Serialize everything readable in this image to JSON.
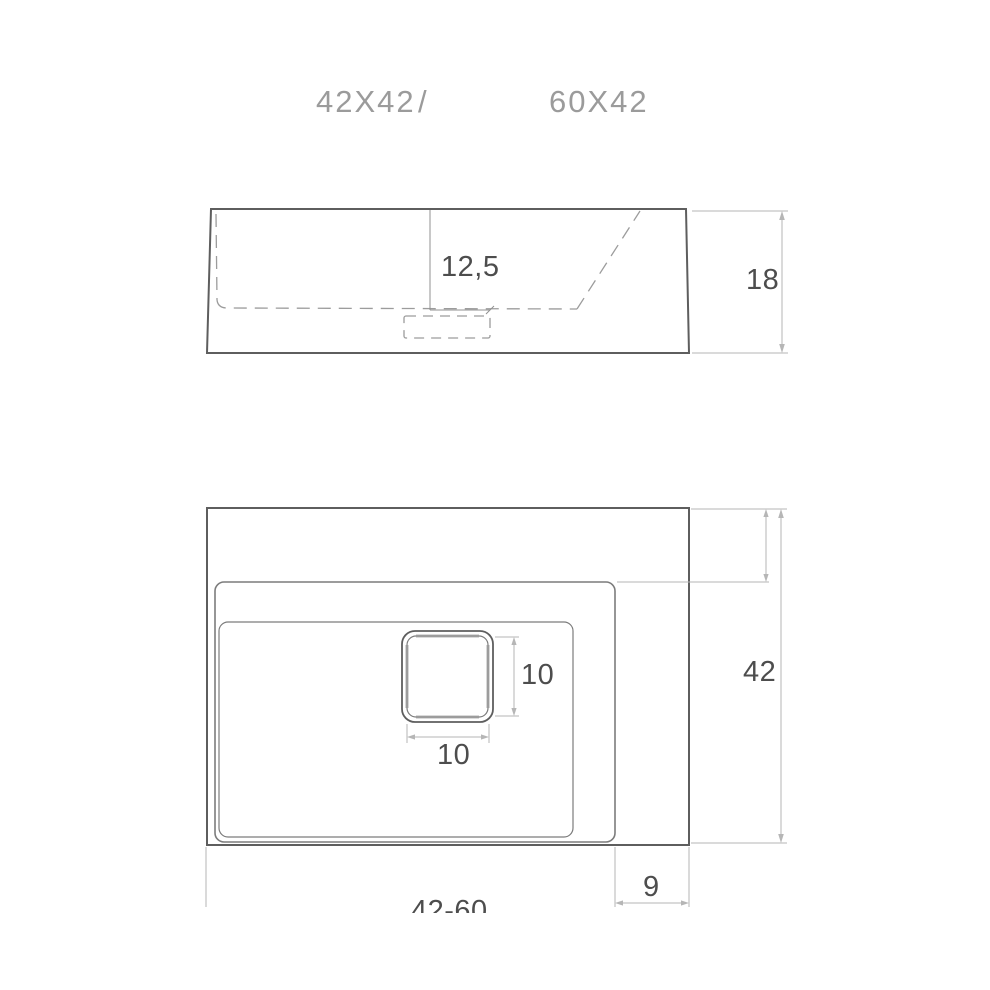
{
  "title": {
    "left": "42X42",
    "separator": "/",
    "right": "60X42"
  },
  "views": {
    "side": {
      "basin_depth": "12,5",
      "height": "18"
    },
    "plan": {
      "drain_height": "10",
      "drain_width": "10",
      "depth": "42",
      "side_deck": "9",
      "width_range": "42-60"
    }
  },
  "colors": {
    "bg": "#ffffff",
    "outline": "#5e5e5e",
    "secondary": "#7c7c7c",
    "dashed": "#9c9c9c",
    "dimline": "#b6b6b6",
    "dimtext": "#4d4d4d",
    "titletext": "#9b9b9b"
  }
}
